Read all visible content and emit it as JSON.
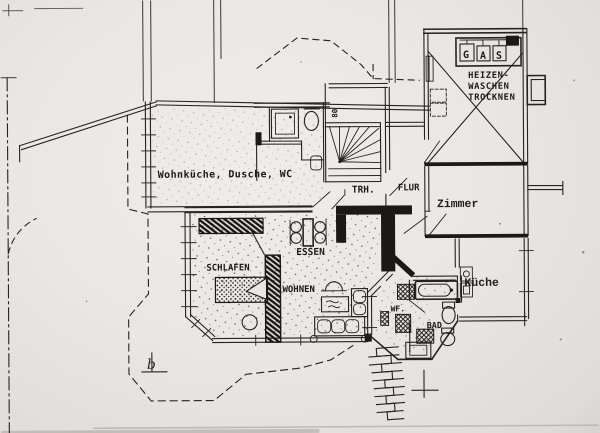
{
  "page": {
    "kind": "scanned architectural floor plan",
    "paper_color": "#e9e7e4",
    "ink_color": "#26231f"
  },
  "floor_plan": {
    "rooms": {
      "wohnkueche": {
        "label": "Wohnküche, Dusche, WC"
      },
      "trh": {
        "label": "TRH."
      },
      "flur": {
        "label": "FLUR"
      },
      "zimmer": {
        "label": "Zimmer"
      },
      "heizraum": {
        "label_line1": "HEIZEN-",
        "label_line2": "WASCHEN",
        "label_line3": "TROCKNEN"
      },
      "schlafen": {
        "label": "SCHLAFEN"
      },
      "wohnen": {
        "label": "WOHNEN"
      },
      "essen": {
        "label": "ESSEN"
      },
      "kueche": {
        "label": "Küche"
      },
      "wf": {
        "label": "WF."
      },
      "bad": {
        "label": "BAD"
      }
    },
    "annotations": {
      "gas_letters": [
        "G",
        "A",
        "S"
      ],
      "stair_width": "80",
      "marker_b": "b"
    },
    "fixtures": [
      "shower-symbol",
      "toilet-symbol",
      "winder-staircase-symbol",
      "gas-unit-symbol",
      "radiator-symbol",
      "bathtub-symbol",
      "bed-symbol",
      "wardrobe-symbol",
      "dining-table-symbol",
      "sofa-symbol",
      "coffee-table-symbol",
      "door-swing-symbol",
      "exterior-steps-symbol",
      "window-symbol"
    ]
  }
}
